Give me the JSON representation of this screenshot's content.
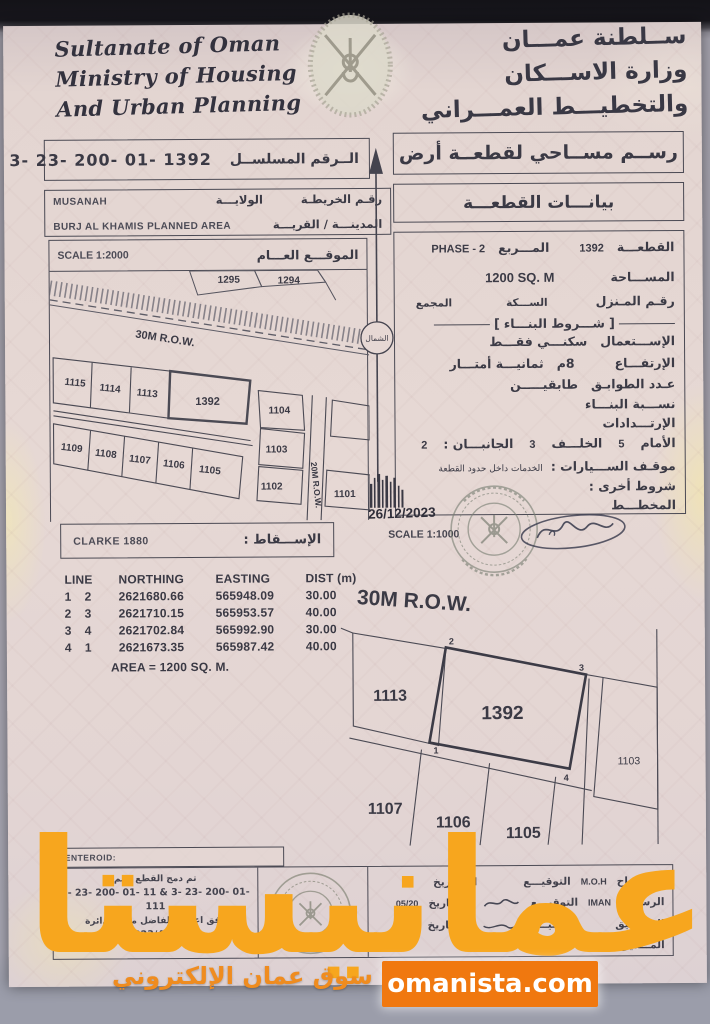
{
  "header": {
    "en_line1": "Sultanate of Oman",
    "en_line2": "Ministry of Housing",
    "en_line3": "And Urban Planning",
    "ar_line1": "ســلطنة عمـــان",
    "ar_line2": "وزارة الاســـكان",
    "ar_line3": "والتخطيـــط العمـــراني",
    "emblem_icon": "oman-national-emblem"
  },
  "serial": {
    "label": "الــرقم المسلســل",
    "value": "3- 23- 200- 01- 1392"
  },
  "survey_title": "رســم مســاحي لقطعــة أرض",
  "location": {
    "map_no_label": "رقـم الخريطـة",
    "wilaya_label": "الولايـــة",
    "wilaya_value": "MUSANAH",
    "city_label": "المدينـــة / القريـــة",
    "city_value": "BURJ AL KHAMIS PLANNED AREA"
  },
  "overview": {
    "scale": "SCALE 1:2000",
    "site_label": "الموقـــع العـــام",
    "row30": "30M R.O.W.",
    "row20": "20M R.O.W.",
    "north": "الشمال",
    "plots": [
      "1295",
      "1294",
      "1115",
      "1114",
      "1113",
      "1392",
      "1104",
      "1109",
      "1108",
      "1107",
      "1106",
      "1105",
      "1103",
      "1102",
      "1101"
    ]
  },
  "info": {
    "title": "بيانـــات القطعـــة",
    "plot_label": "القطعـــة",
    "plot_value": "1392",
    "square_label": "المـــربع",
    "square_value": "PHASE - 2",
    "area_label": "المســـاحة",
    "area_value": "1200 SQ. M",
    "house_label": "رقـم المـنزل",
    "street_label": "الســـكة",
    "complex_label": "المجمع",
    "building_header": "شـــروط البنـــاء",
    "usage_label": "الإســـتعمال",
    "usage_value": "سكنـــي فقـــط",
    "height_label": "الإرتفـــاع",
    "height_m": "8م",
    "height_words": "ثمانيـــة أمتـــار",
    "floors_label": "عـدد الطوابـق",
    "floors_value": "طابقيـــــن",
    "ratio_label": "نســـبة البنـــاء",
    "setbacks_label": "الإرتـــدادات",
    "front_label": "الأمام",
    "front_value": "5",
    "back_label": "الخلـــف",
    "back_value": "3",
    "sides_label": "الجانبـــان :",
    "sides_value": "2",
    "parking_label": "موقـف الســـيارات :",
    "parking_value": "الخدمات داخل حدود القطعة",
    "other_label": "شروط أخرى :",
    "planner_label": "المخطـــط"
  },
  "stamp_date": "26/12/2023",
  "projection": {
    "label": "الإســـقاط :",
    "value": "CLARKE 1880"
  },
  "detail": {
    "scale": "SCALE 1:1000",
    "row30": "30M R.O.W.",
    "plots": [
      "1113",
      "1392",
      "1103",
      "1107",
      "1106",
      "1105"
    ],
    "corners": [
      "1",
      "2",
      "3",
      "4"
    ]
  },
  "survey_table": {
    "h_line": "LINE",
    "h_northing": "NORTHING",
    "h_easting": "EASTING",
    "h_dist": "DIST (m)",
    "rows": [
      [
        "1",
        "2",
        "2621680.66",
        "565948.09",
        "30.00"
      ],
      [
        "2",
        "3",
        "2621710.15",
        "565953.57",
        "40.00"
      ],
      [
        "3",
        "4",
        "2621702.84",
        "565992.90",
        "30.00"
      ],
      [
        "4",
        "1",
        "2621673.35",
        "565987.42",
        "40.00"
      ]
    ],
    "area_note": "AREA = 1200 SQ. M."
  },
  "bottom": {
    "centeroid_label": "CENTEROID:",
    "note_line1": "تم دمج القطع رقم",
    "note_line2": "3- 23- 200- 01- 11  &  3- 23- 200- 01- 111",
    "note_line3": "وفق اعتماد الفاضل مدير الدائرة",
    "note_line4": "(2023/4476)",
    "surveyor_label": "المســـاح",
    "surveyor_value": "M.O.H",
    "draftsman_label": "الرســـم",
    "draftsman_value": "IMAN",
    "audit_label": "التـــدقيق",
    "director_label": "المـــدير",
    "sign_label": "التوقيـــع",
    "date_label": "التـــاريخ",
    "date_value": "05/20"
  },
  "watermark": {
    "big": "عمانيستا",
    "tagline": "سوق عمان الإلكتروني",
    "badge": "omanista.com"
  },
  "colors": {
    "watermark": "#f7a61e",
    "badge_bg": "#f0780f",
    "tagline": "#ef8c1f"
  }
}
